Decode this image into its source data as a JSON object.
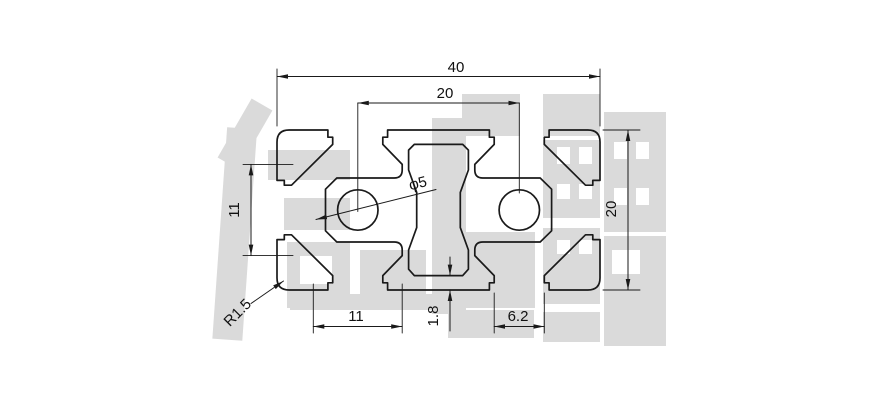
{
  "title": "Aluminum extrusion profile cross-section drawing (2040 V-slot)",
  "dims": {
    "overall_width": {
      "label": "40"
    },
    "hole_pitch": {
      "label": "20"
    },
    "side_cavity_width": {
      "label": "11"
    },
    "center_hole": {
      "label": "φ5"
    },
    "overall_height": {
      "label": "20"
    },
    "bottom_cavity_width": {
      "label": "11"
    },
    "wall_thickness": {
      "label": "1.8"
    },
    "slot_opening": {
      "label": "6.2"
    },
    "corner_radius": {
      "label": "R1.5"
    }
  },
  "colors": {
    "line": "#1a1a1a",
    "watermark": "#dadada",
    "background": "#ffffff"
  }
}
